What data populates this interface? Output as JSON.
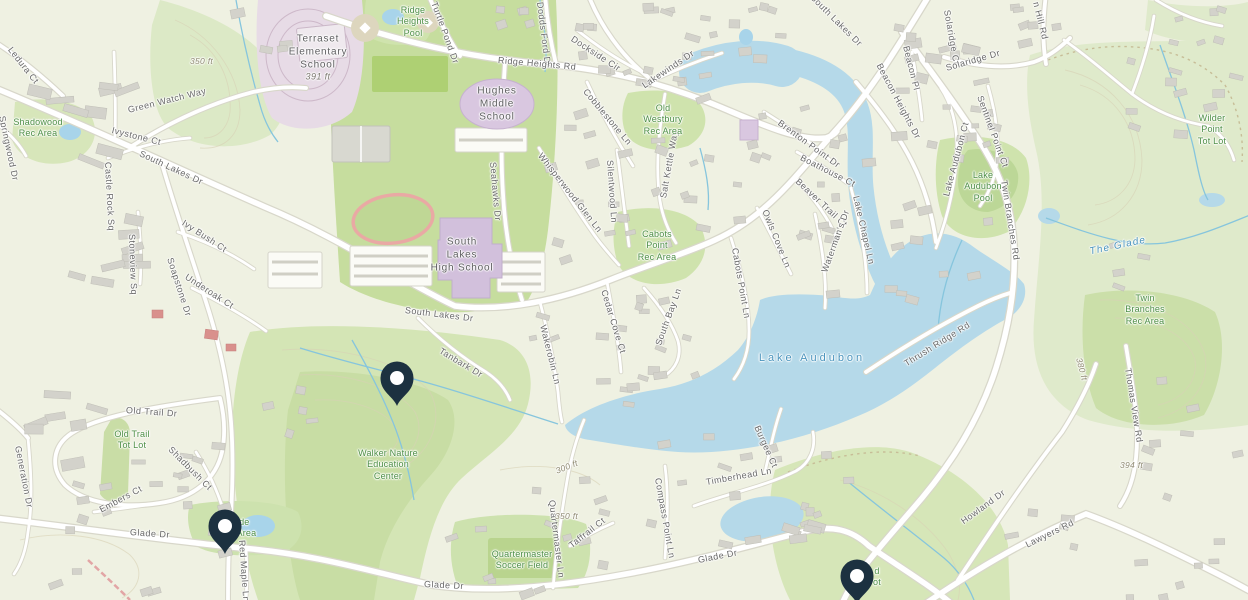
{
  "map": {
    "name": "South Lakes / Lake Audubon area map",
    "colors": {
      "land": "#eff1e2",
      "woodland": "#d9e7c2",
      "woodland_dark": "#c8dda4",
      "campus_green": "#c6dd9e",
      "water": "#b5d9e9",
      "stream": "#86c5dd",
      "road_fill": "#ffffff",
      "road_casing": "#d8d7ca",
      "building": "#d3d2cb",
      "school_fill": "#d9c7e0",
      "school_ground": "#e7dbe6",
      "track_outline": "#e9a9a4",
      "marker": "#1c3140",
      "label_street": "#686868",
      "label_area": "#4e8f46",
      "label_water": "#4a94bd"
    },
    "markers": [
      {
        "name": "marker-walker-nature-area",
        "x": 397,
        "y": 406
      },
      {
        "name": "marker-glade-rec-area",
        "x": 225,
        "y": 554
      },
      {
        "name": "marker-glade-south",
        "x": 857,
        "y": 604
      }
    ],
    "labels": {
      "streets": [
        {
          "t": "Ledura Ct",
          "x": 10,
          "y": 48,
          "r": 52
        },
        {
          "t": "Springwood Dr",
          "x": 2,
          "y": 116,
          "r": 78
        },
        {
          "t": "Castle Rock Sq",
          "x": 108,
          "y": 162,
          "r": 87
        },
        {
          "t": "Green Watch Way",
          "x": 128,
          "y": 110,
          "r": -14
        },
        {
          "t": "Ivystone Ct",
          "x": 112,
          "y": 130,
          "r": 14
        },
        {
          "t": "South Lakes Dr",
          "x": 140,
          "y": 153,
          "r": 25
        },
        {
          "t": "Stoneview Sq",
          "x": 132,
          "y": 234,
          "r": 88
        },
        {
          "t": "Ivy Bush Ct",
          "x": 183,
          "y": 222,
          "r": 33
        },
        {
          "t": "Underoak Ct",
          "x": 186,
          "y": 276,
          "r": 33
        },
        {
          "t": "Soapstone Dr",
          "x": 170,
          "y": 258,
          "r": 72
        },
        {
          "t": "Turtle Pond Dr",
          "x": 434,
          "y": 2,
          "r": 70
        },
        {
          "t": "Dodds Ford Dr",
          "x": 540,
          "y": 2,
          "r": 83
        },
        {
          "t": "Ridge Heights Rd",
          "x": 498,
          "y": 60,
          "r": 5
        },
        {
          "t": "Dockside Cir",
          "x": 572,
          "y": 38,
          "r": 33
        },
        {
          "t": "Lakewinds Dr",
          "x": 643,
          "y": 86,
          "r": -34
        },
        {
          "t": "Cobblestone Ln",
          "x": 585,
          "y": 90,
          "r": 50
        },
        {
          "t": "Salt Kettle Way",
          "x": 663,
          "y": 198,
          "r": -80
        },
        {
          "t": "Seahawks Dr",
          "x": 493,
          "y": 162,
          "r": 85
        },
        {
          "t": "Whisperwood Glen Ln",
          "x": 540,
          "y": 154,
          "r": 52
        },
        {
          "t": "Silentwood Ln",
          "x": 610,
          "y": 160,
          "r": 86
        },
        {
          "t": "South Lakes Dr",
          "x": 812,
          "y": -4,
          "r": 45
        },
        {
          "t": "Brenton Point Dr",
          "x": 779,
          "y": 122,
          "r": 36
        },
        {
          "t": "Boathouse Ct",
          "x": 801,
          "y": 157,
          "r": 27
        },
        {
          "t": "Beaver Trail Ct",
          "x": 797,
          "y": 180,
          "r": 43
        },
        {
          "t": "Owls Cove Ln",
          "x": 765,
          "y": 210,
          "r": 68
        },
        {
          "t": "Waterman's Dr",
          "x": 824,
          "y": 272,
          "r": -70
        },
        {
          "t": "Lake Chapel Ln",
          "x": 856,
          "y": 196,
          "r": 77
        },
        {
          "t": "Cabots Point Ln",
          "x": 735,
          "y": 248,
          "r": 80
        },
        {
          "t": "South Bay Ln",
          "x": 658,
          "y": 345,
          "r": -70
        },
        {
          "t": "Wakerobin Ln",
          "x": 543,
          "y": 325,
          "r": 76
        },
        {
          "t": "Cedar Cove Ct",
          "x": 604,
          "y": 290,
          "r": 73
        },
        {
          "t": "Tanbark Dr",
          "x": 440,
          "y": 350,
          "r": 31
        },
        {
          "t": "South Lakes Dr",
          "x": 405,
          "y": 310,
          "r": 7
        },
        {
          "t": "Beacon Heights Dr",
          "x": 879,
          "y": 64,
          "r": 62
        },
        {
          "t": "Beacon Pl",
          "x": 906,
          "y": 46,
          "r": 76
        },
        {
          "t": "Solaridge Ct",
          "x": 947,
          "y": 10,
          "r": 80
        },
        {
          "t": "Solaridge Dr",
          "x": 946,
          "y": 68,
          "r": -16
        },
        {
          "t": "Sentinel Point Ct",
          "x": 980,
          "y": 96,
          "r": 70
        },
        {
          "t": "n Hill Rd",
          "x": 1036,
          "y": 2,
          "r": 76
        },
        {
          "t": "Lake Audubon Ct",
          "x": 946,
          "y": 196,
          "r": -75
        },
        {
          "t": "Twin Branches Rd",
          "x": 1004,
          "y": 180,
          "r": 81
        },
        {
          "t": "Thrush Ridge Rd",
          "x": 905,
          "y": 364,
          "r": -32
        },
        {
          "t": "Thomas View Rd",
          "x": 1128,
          "y": 368,
          "r": 81
        },
        {
          "t": "Howland Dr",
          "x": 962,
          "y": 522,
          "r": -36
        },
        {
          "t": "Lawyers Rd",
          "x": 1026,
          "y": 545,
          "r": -26
        },
        {
          "t": "Old Trail Dr",
          "x": 126,
          "y": 410,
          "r": 4
        },
        {
          "t": "Shadbush Ct",
          "x": 170,
          "y": 448,
          "r": 45
        },
        {
          "t": "Embers Ct",
          "x": 100,
          "y": 510,
          "r": -28
        },
        {
          "t": "Generation Dr",
          "x": 18,
          "y": 446,
          "r": 79
        },
        {
          "t": "Red Maple Ln",
          "x": 242,
          "y": 540,
          "r": 86
        },
        {
          "t": "Glade Dr",
          "x": 130,
          "y": 532,
          "r": 4
        },
        {
          "t": "Glade Dr",
          "x": 424,
          "y": 584,
          "r": 3
        },
        {
          "t": "Glade Dr",
          "x": 698,
          "y": 560,
          "r": -11
        },
        {
          "t": "Quartermaster Ln",
          "x": 552,
          "y": 500,
          "r": 83
        },
        {
          "t": "Taffrail Ct",
          "x": 570,
          "y": 546,
          "r": -38
        },
        {
          "t": "Compass Point Ln",
          "x": 658,
          "y": 478,
          "r": 80
        },
        {
          "t": "Timberhead Ln",
          "x": 706,
          "y": 482,
          "r": -10
        },
        {
          "t": "Burgee Ct",
          "x": 757,
          "y": 426,
          "r": 66
        }
      ],
      "areas": [
        {
          "lines": [
            "Shadowood",
            "Rec Area"
          ],
          "x": 38,
          "y": 128
        },
        {
          "lines": [
            "Ridge",
            "Heights",
            "Pool"
          ],
          "x": 413,
          "y": 22
        },
        {
          "lines": [
            "Old",
            "Westbury",
            "Rec Area"
          ],
          "x": 663,
          "y": 120
        },
        {
          "lines": [
            "Cabots",
            "Point",
            "Rec Area"
          ],
          "x": 657,
          "y": 246
        },
        {
          "lines": [
            "Lake",
            "Audubon",
            "Pool"
          ],
          "x": 983,
          "y": 187
        },
        {
          "lines": [
            "Wilder",
            "Point",
            "Tot Lot"
          ],
          "x": 1212,
          "y": 130
        },
        {
          "lines": [
            "Twin",
            "Branches",
            "Rec Area"
          ],
          "x": 1145,
          "y": 310
        },
        {
          "lines": [
            "Old Trail",
            "Tot Lot"
          ],
          "x": 132,
          "y": 440
        },
        {
          "lines": [
            "Walker Nature",
            "Education",
            "Center"
          ],
          "x": 388,
          "y": 465
        },
        {
          "lines": [
            "Quartermaster",
            "Soccer Field"
          ],
          "x": 522,
          "y": 560
        },
        {
          "lines": [
            "Glade",
            "Rec Area"
          ],
          "x": 237,
          "y": 528
        },
        {
          "lines": [
            "d",
            "ot"
          ],
          "x": 877,
          "y": 577
        }
      ],
      "schools": [
        {
          "lines": [
            "Terraset",
            "Elementary",
            "School"
          ],
          "elev": "391 ft",
          "x": 318,
          "y": 58
        },
        {
          "lines": [
            "Hughes",
            "Middle",
            "School"
          ],
          "x": 497,
          "y": 104
        },
        {
          "lines": [
            "South",
            "Lakes",
            "High School"
          ],
          "x": 462,
          "y": 255
        }
      ],
      "water": [
        {
          "t": "Lake Audubon",
          "x": 812,
          "y": 358,
          "r": 0
        },
        {
          "t": "The Glade",
          "x": 1118,
          "y": 246,
          "r": -12,
          "it": true
        }
      ],
      "elevations": [
        {
          "t": "350 ft",
          "x": 190,
          "y": 61,
          "r": 0
        },
        {
          "t": "300 ft",
          "x": 556,
          "y": 471,
          "r": -22
        },
        {
          "t": "350 ft",
          "x": 555,
          "y": 516,
          "r": 0
        },
        {
          "t": "380 ft",
          "x": 1079,
          "y": 358,
          "r": 75
        },
        {
          "t": "394 ft",
          "x": 1120,
          "y": 465,
          "r": 0
        }
      ]
    }
  }
}
